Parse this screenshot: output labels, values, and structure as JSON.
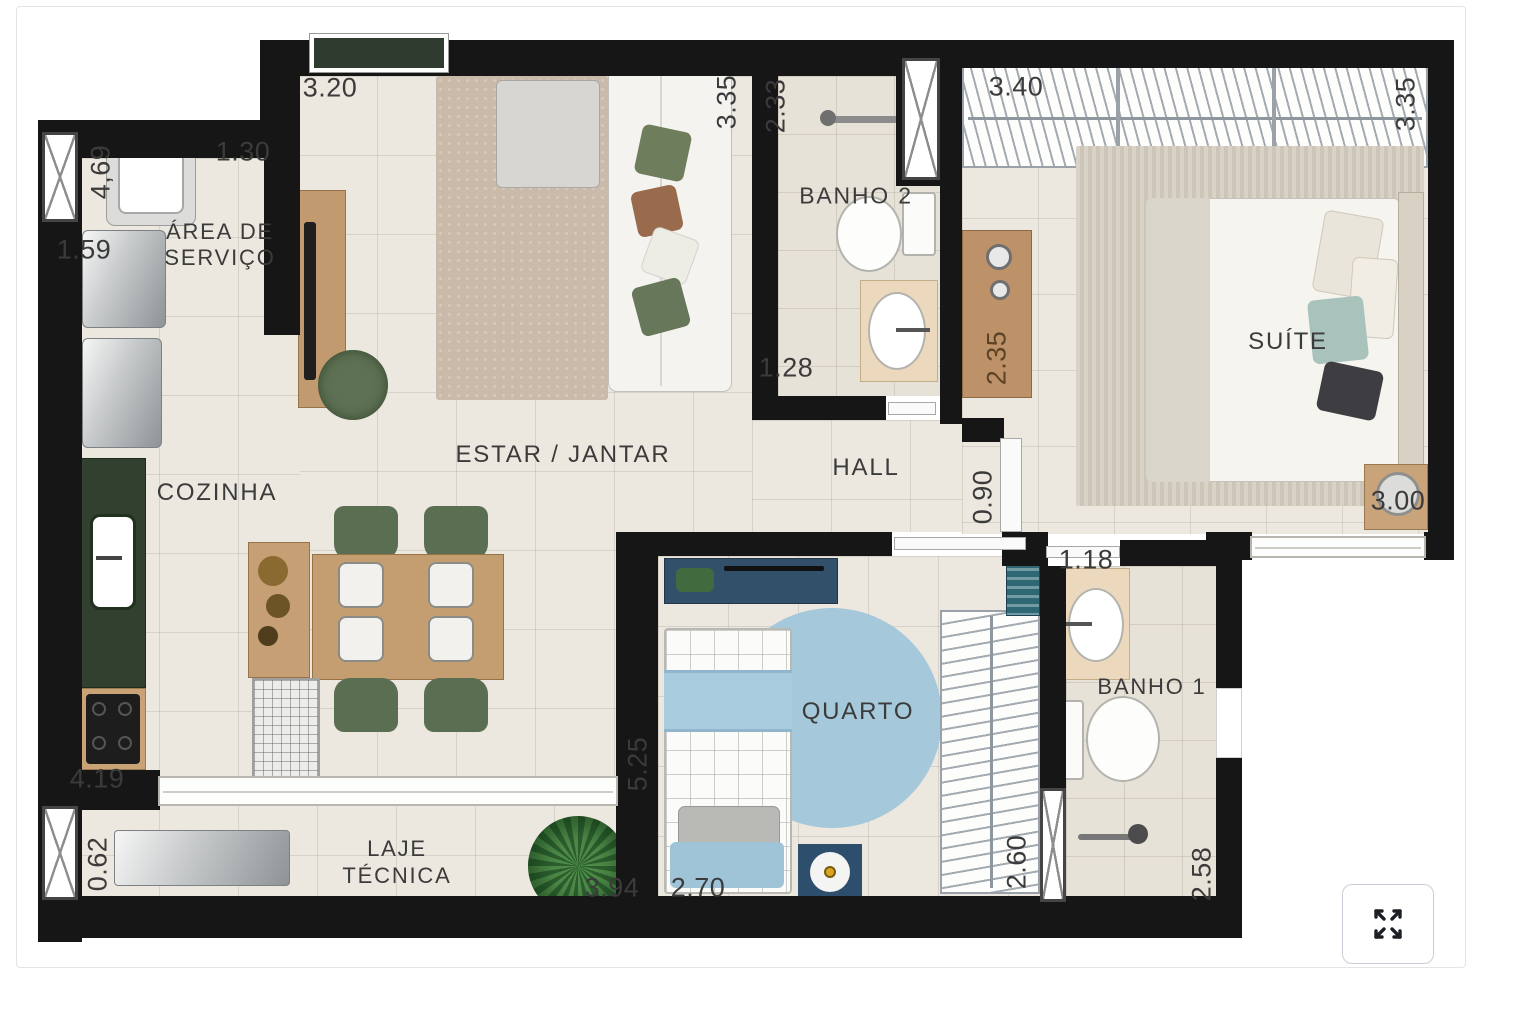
{
  "page": {
    "background": "#ffffff",
    "type": "apartment-floor-plan"
  },
  "plan": {
    "rooms": {
      "area_de_servico": {
        "line1": "ÁREA DE",
        "line2": "SERVIÇO"
      },
      "cozinha": {
        "name": "COZINHA"
      },
      "estar_jantar": {
        "name": "ESTAR / JANTAR"
      },
      "banho2": {
        "name": "BANHO 2"
      },
      "suite": {
        "name": "SUÍTE"
      },
      "hall": {
        "name": "HALL"
      },
      "quarto": {
        "name": "QUARTO"
      },
      "banho1": {
        "name": "BANHO 1"
      },
      "laje_tecnica": {
        "line1": "LAJE",
        "line2": "TÉCNICA"
      }
    },
    "measurements": {
      "servico_height": "4,69",
      "servico_width": "1.30",
      "servico_washer": "1.59",
      "estar_width": "3.20",
      "estar_height": "3.35",
      "banho2_height": "2.33",
      "banho2_width": "1.28",
      "suite_width": "3.40",
      "suite_height": "3.35",
      "suite_closet": "2.35",
      "suite_bed_wall": "3.00",
      "hall_width": "0.90",
      "cozinha_wall": "4.19",
      "estar_wall": "5.25",
      "laje_window": "0.62",
      "laje_width": "3.94",
      "quarto_width": "2.70",
      "quarto_closet": "2.60",
      "banho1_width": "1.18",
      "banho1_height": "2.58"
    },
    "colors": {
      "wall": "#161616",
      "floor": "#ece8e0",
      "bath_floor": "#e7e2d7",
      "counter_green": "#31402f",
      "chair_green": "#5a6f52",
      "wood": "#c49e71",
      "kid_blue": "#a5c8da",
      "kid_navy": "#2e4e6e",
      "label_text": "#3b3b3b"
    }
  },
  "controls": {
    "fullscreen": {
      "icon": "expand-arrows"
    }
  }
}
